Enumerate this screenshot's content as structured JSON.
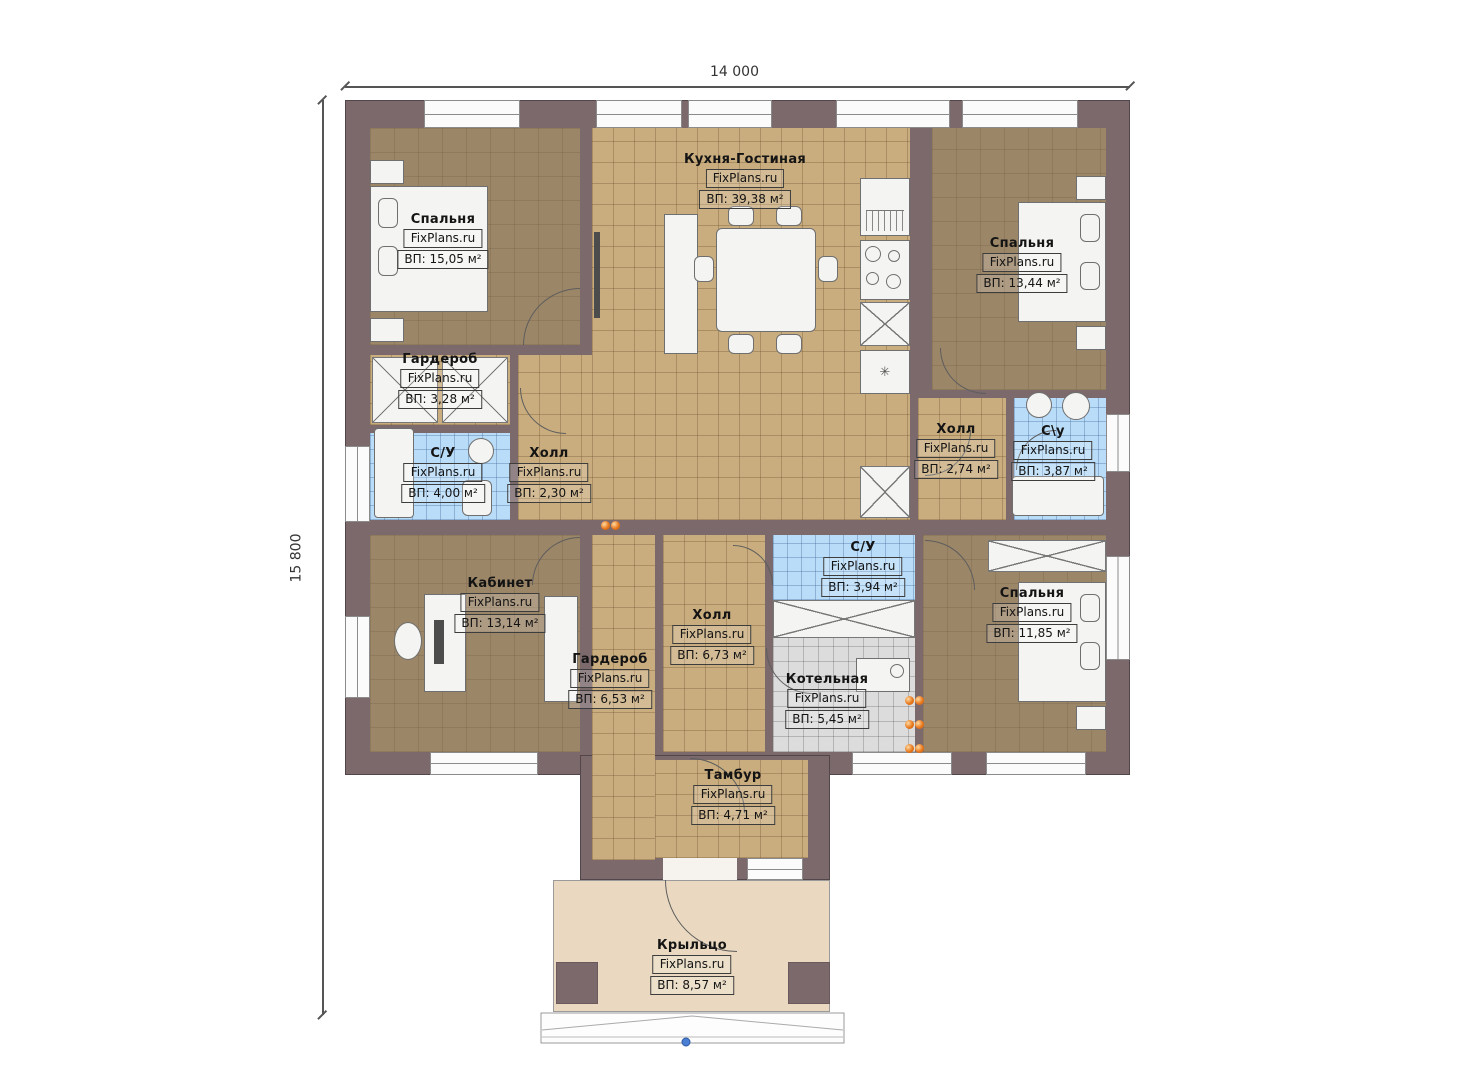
{
  "dimensions": {
    "top": "14 000",
    "left": "15 800"
  },
  "watermark": "FixPlans.ru",
  "rooms": [
    {
      "name": "Спальня",
      "area": "ВП: 15,05 м²"
    },
    {
      "name": "Кухня-Гостиная",
      "area": "ВП: 39,38 м²"
    },
    {
      "name": "Спальня",
      "area": "ВП: 13,44 м²"
    },
    {
      "name": "Гардероб",
      "area": "ВП: 3,28 м²"
    },
    {
      "name": "С/У",
      "area": "ВП: 4,00 м²"
    },
    {
      "name": "Холл",
      "area": "ВП: 2,30 м²"
    },
    {
      "name": "Холл",
      "area": "ВП: 2,74 м²"
    },
    {
      "name": "С\\у",
      "area": "ВП: 3,87 м²"
    },
    {
      "name": "Кабинет",
      "area": "ВП: 13,14 м²"
    },
    {
      "name": "Гардероб",
      "area": "ВП: 6,53 м²"
    },
    {
      "name": "Холл",
      "area": "ВП: 6,73 м²"
    },
    {
      "name": "С/У",
      "area": "ВП: 3,94 м²"
    },
    {
      "name": "Котельная",
      "area": "ВП: 5,45 м²"
    },
    {
      "name": "Спальня",
      "area": "ВП: 11,85 м²"
    },
    {
      "name": "Тамбур",
      "area": "ВП: 4,71 м²"
    },
    {
      "name": "Крыльцо",
      "area": "ВП: 8,57 м²"
    }
  ],
  "colors": {
    "wall": "#7b696c",
    "floor_dark": "#9c8668",
    "floor_tan": "#c9ad7e",
    "floor_wet": "#b9dcf8",
    "floor_boiler": "#dcdcdc",
    "porch": "#ead9c0",
    "radiator": "#e8791e"
  }
}
